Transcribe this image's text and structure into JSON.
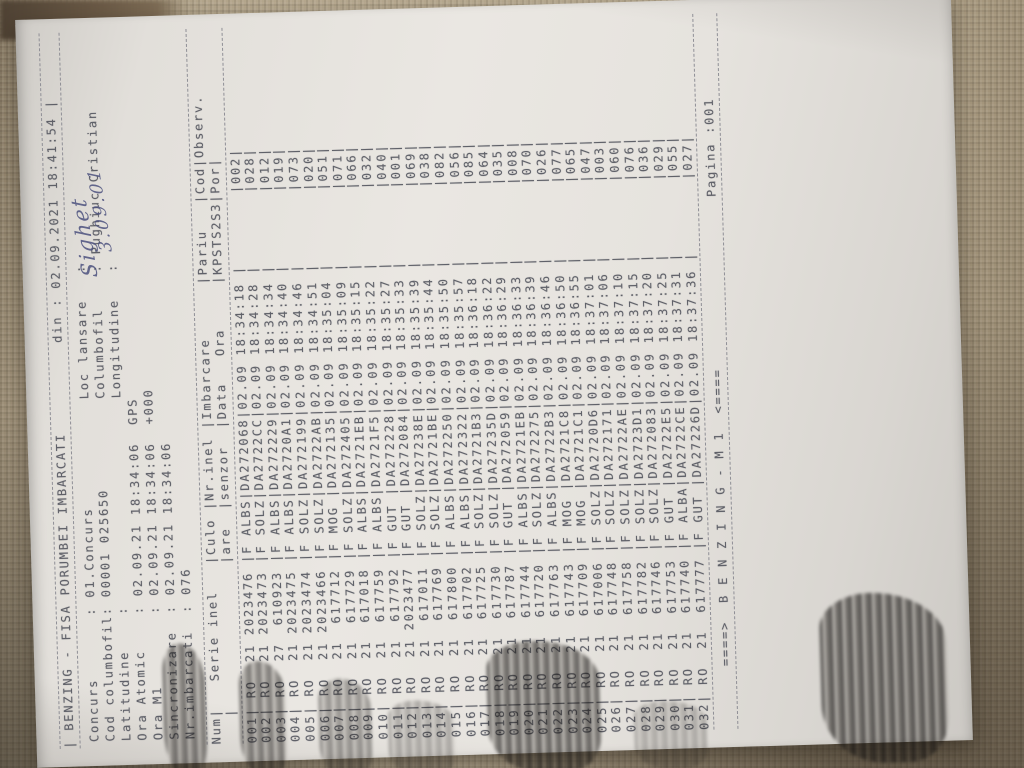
{
  "doc": {
    "title_line": "| BENZING - FISA PORUMBEI IMBARCATI          din : 02.09.2021 18:41:54 |",
    "info_lines": [
      "Concurs       : 01.Concurs            Loc lansare   :",
      "Cod columbofil: 00001 025650          Columbofil    : Pughiuc Cristian",
      "Latitudine    :                       Longitudine   :",
      "Ora Atomic    : 02.09.21 18:34:06  GPS",
      "Ora M1        : 02.09.21 18:34:06  +000",
      "Sincronizare  : 02.09.21 18:34:06",
      "Nr.imbarcati  : 076"
    ],
    "table": {
      "header_line1": "Num|   Serie inel   |Culo |Nr.inel |Imbarcare      |Pariu   |Cod|Observ.",
      "header_line2": "   |                |are  |senzor  |Data   Ora     |KPSTS2S3|Por|       ",
      "rows": [
        [
          "001",
          "RO",
          "21",
          "2023476",
          "F",
          "ALBS",
          "DA272068",
          "02.09",
          "18:34:18",
          "",
          "002",
          ""
        ],
        [
          "002",
          "RO",
          "21",
          "2023473",
          "F",
          "SOLZ",
          "DA2722CC",
          "02.09",
          "18:34:28",
          "",
          "028",
          ""
        ],
        [
          "003",
          "RO",
          "27",
          "610923",
          "F",
          "ALBS",
          "DA272229",
          "02.09",
          "18:34:34",
          "",
          "012",
          ""
        ],
        [
          "004",
          "RO",
          "21",
          "2023475",
          "F",
          "ALBS",
          "DA2720A1",
          "02.09",
          "18:34:40",
          "",
          "019",
          ""
        ],
        [
          "005",
          "RO",
          "21",
          "2023474",
          "F",
          "SOLZ",
          "DA272199",
          "02.09",
          "18:34:46",
          "",
          "073",
          ""
        ],
        [
          "006",
          "RO",
          "21",
          "2023466",
          "F",
          "SOLZ",
          "DA2722AB",
          "02.09",
          "18:34:51",
          "",
          "020",
          ""
        ],
        [
          "007",
          "RO",
          "21",
          "617712",
          "F",
          "MOG",
          "DA272135",
          "02.09",
          "18:35:04",
          "",
          "051",
          ""
        ],
        [
          "008",
          "RO",
          "21",
          "617729",
          "F",
          "SOLZ",
          "DA272405",
          "02.09",
          "18:35:09",
          "",
          "071",
          ""
        ],
        [
          "009",
          "RO",
          "21",
          "617018",
          "F",
          "ALBS",
          "DA2721EB",
          "02.09",
          "18:35:15",
          "",
          "066",
          ""
        ],
        [
          "010",
          "RO",
          "21",
          "617759",
          "F",
          "ALBS",
          "DA2721F5",
          "02.09",
          "18:35:22",
          "",
          "032",
          ""
        ],
        [
          "011",
          "RO",
          "21",
          "617792",
          "F",
          "GUT",
          "DA272228",
          "02.09",
          "18:35:27",
          "",
          "040",
          ""
        ],
        [
          "012",
          "RO",
          "21",
          "2023477",
          "F",
          "GUT",
          "DA272084",
          "02.09",
          "18:35:33",
          "",
          "001",
          ""
        ],
        [
          "013",
          "RO",
          "21",
          "617011",
          "F",
          "SOLZ",
          "DA27238E",
          "02.09",
          "18:35:39",
          "",
          "069",
          ""
        ],
        [
          "014",
          "RO",
          "21",
          "617769",
          "F",
          "SOLZ",
          "DA2721BE",
          "02.09",
          "18:35:44",
          "",
          "038",
          ""
        ],
        [
          "015",
          "RO",
          "21",
          "617800",
          "F",
          "ALBS",
          "DA272250",
          "02.09",
          "18:35:50",
          "",
          "082",
          ""
        ],
        [
          "016",
          "RO",
          "21",
          "617702",
          "F",
          "ALBS",
          "DA272322",
          "02.09",
          "18:35:57",
          "",
          "056",
          ""
        ],
        [
          "017",
          "RO",
          "21",
          "617725",
          "F",
          "SOLZ",
          "DA2721B3",
          "02.09",
          "18:36:18",
          "",
          "085",
          ""
        ],
        [
          "018",
          "RO",
          "21",
          "617730",
          "F",
          "SOLZ",
          "DA27235D",
          "02.09",
          "18:36:22",
          "",
          "064",
          ""
        ],
        [
          "019",
          "RO",
          "21",
          "617787",
          "F",
          "GUT",
          "DA272059",
          "02.09",
          "18:36:29",
          "",
          "035",
          ""
        ],
        [
          "020",
          "RO",
          "21",
          "617744",
          "F",
          "ALBS",
          "DA2721EB",
          "02.09",
          "18:36:33",
          "",
          "008",
          ""
        ],
        [
          "021",
          "RO",
          "21",
          "617720",
          "F",
          "SOLZ",
          "DA272275",
          "02.09",
          "18:36:39",
          "",
          "070",
          ""
        ],
        [
          "022",
          "RO",
          "21",
          "617763",
          "F",
          "ALBS",
          "DA2722B3",
          "02.09",
          "18:36:46",
          "",
          "026",
          ""
        ],
        [
          "023",
          "RO",
          "21",
          "617743",
          "F",
          "MOG",
          "DA2721C8",
          "02.09",
          "18:36:50",
          "",
          "077",
          ""
        ],
        [
          "024",
          "RO",
          "21",
          "617709",
          "F",
          "MOG",
          "DA2721C1",
          "02.09",
          "18:36:55",
          "",
          "065",
          ""
        ],
        [
          "025",
          "RO",
          "21",
          "617006",
          "F",
          "SOLZ",
          "DA2720D6",
          "02.09",
          "18:37:01",
          "",
          "047",
          ""
        ],
        [
          "026",
          "RO",
          "21",
          "617748",
          "F",
          "SOLZ",
          "DA272171",
          "02.09",
          "18:37:06",
          "",
          "003",
          ""
        ],
        [
          "027",
          "RO",
          "21",
          "617758",
          "F",
          "SOLZ",
          "DA2722AE",
          "02.09",
          "18:37:10",
          "",
          "060",
          ""
        ],
        [
          "028",
          "RO",
          "21",
          "617782",
          "F",
          "SOLZ",
          "DA2723D1",
          "02.09",
          "18:37:15",
          "",
          "076",
          ""
        ],
        [
          "029",
          "RO",
          "21",
          "617746",
          "F",
          "SOLZ",
          "DA272083",
          "02.09",
          "18:37:20",
          "",
          "036",
          ""
        ],
        [
          "030",
          "RO",
          "21",
          "617753",
          "F",
          "GUT",
          "DA2722E5",
          "02.09",
          "18:37:25",
          "",
          "029",
          ""
        ],
        [
          "031",
          "RO",
          "21",
          "617740",
          "F",
          "ALBA",
          "DA2722CE",
          "02.09",
          "18:37:31",
          "",
          "055",
          ""
        ],
        [
          "032",
          "RO",
          "21",
          "617777",
          "F",
          "GUT",
          "DA27226D",
          "02.09",
          "18:37:36",
          "",
          "027",
          ""
        ]
      ]
    },
    "footer_line": "       ====>  B E N Z I N G - M 1  <====                   Pagina :001",
    "handwriting": [
      "Sighet",
      "3.09.01"
    ]
  }
}
